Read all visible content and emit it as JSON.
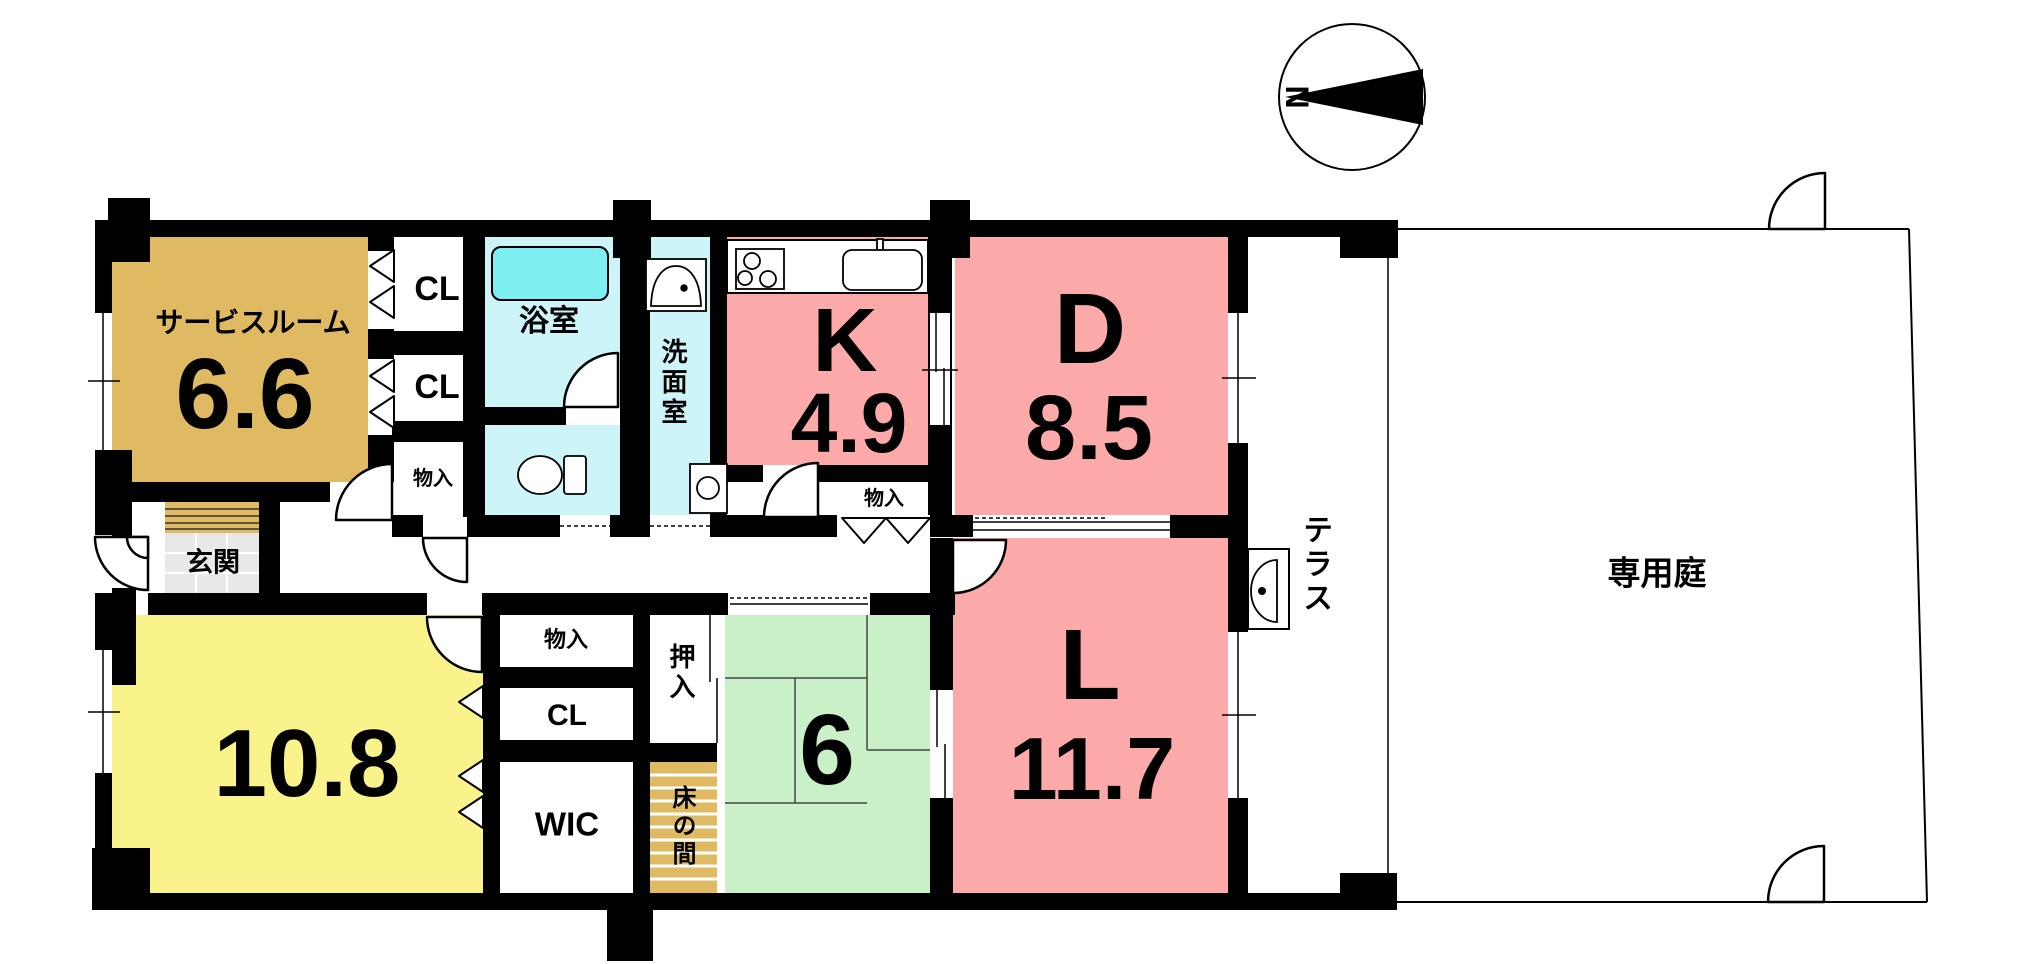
{
  "colors": {
    "wall": "#000000",
    "tan": "#dfba62",
    "aqua": "#cdf4f8",
    "bathtub_aqua": "#7deef2",
    "pink": "#fba9a9",
    "yellow": "#faf38c",
    "green": "#c9f0c6",
    "tile_gray": "#e8e8e8",
    "line": "#000000"
  },
  "compass": {
    "north_label": "N"
  },
  "rooms": {
    "service_room": {
      "name": "サービスルーム",
      "size": "6.6"
    },
    "closet_1": {
      "label": "CL"
    },
    "closet_2": {
      "label": "CL"
    },
    "storage_1": {
      "label": "物入"
    },
    "bathroom": {
      "name": "浴室"
    },
    "washroom": {
      "name": "洗面室"
    },
    "kitchen": {
      "name": "K",
      "size": "4.9"
    },
    "dining": {
      "name": "D",
      "size": "8.5"
    },
    "storage_2": {
      "label": "物入"
    },
    "entrance": {
      "name": "玄関"
    },
    "western_room": {
      "size": "10.8"
    },
    "storage_3": {
      "label": "物入"
    },
    "closet_3": {
      "label": "CL"
    },
    "walk_in_closet": {
      "label": "WIC"
    },
    "oshiire": {
      "name": "押入"
    },
    "tokonoma": {
      "name": "床の間"
    },
    "japanese_room": {
      "size": "6"
    },
    "living": {
      "name": "L",
      "size": "11.7"
    },
    "terrace": {
      "name": "テラス"
    },
    "private_garden": {
      "name": "専用庭"
    }
  },
  "fixtures": {
    "bathtub": "bathtub-icon",
    "wash_basin": "wash-basin-icon",
    "toilet": "toilet-icon",
    "washer_pan": "washing-machine-pan-icon",
    "stove": "stove-icon",
    "kitchen_sink": "kitchen-sink-icon",
    "terrace_faucet": "outdoor-sink-icon"
  }
}
